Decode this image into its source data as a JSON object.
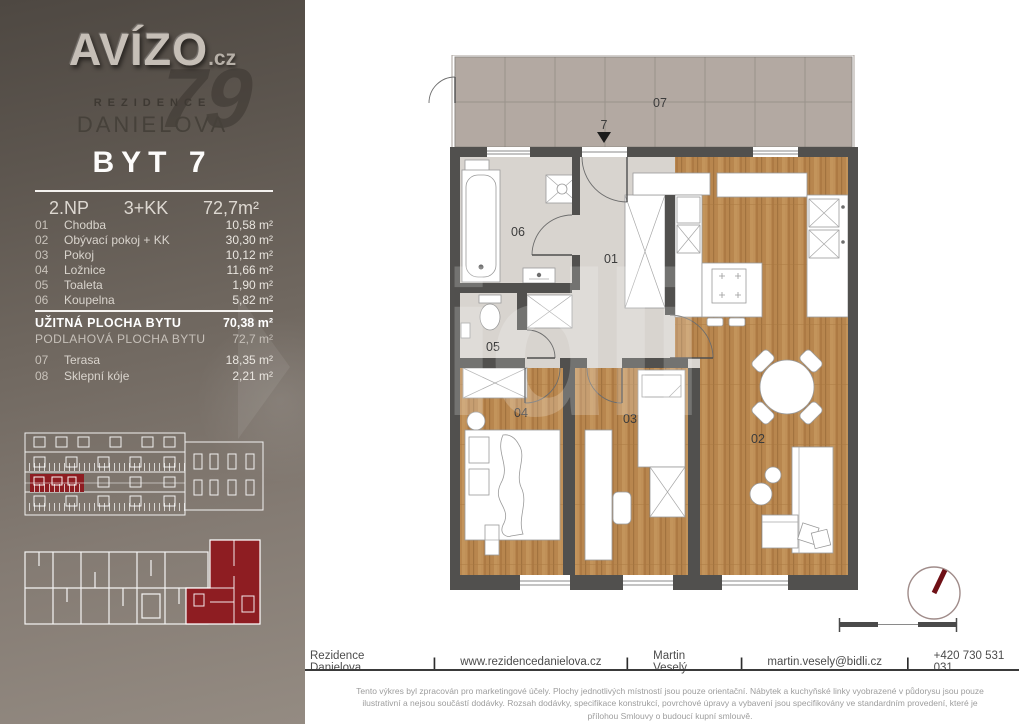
{
  "branding": {
    "logo": "AVÍZO",
    "logo_tld": ".cz",
    "logo_ghost": "79",
    "residence": "REZIDENCE",
    "name": "DANIELOVA"
  },
  "unit": {
    "title": "BYT 7",
    "floor": "2.NP",
    "disposition": "3+KK",
    "area": "72,7m²"
  },
  "rooms": [
    {
      "num": "01",
      "name": "Chodba",
      "area": "10,58 m²"
    },
    {
      "num": "02",
      "name": "Obývací pokoj + KK",
      "area": "30,30 m²"
    },
    {
      "num": "03",
      "name": "Pokoj",
      "area": "10,12 m²"
    },
    {
      "num": "04",
      "name": "Ložnice",
      "area": "11,66 m²"
    },
    {
      "num": "05",
      "name": "Toaleta",
      "area": "1,90 m²"
    },
    {
      "num": "06",
      "name": "Koupelna",
      "area": "5,82 m²"
    }
  ],
  "summary": {
    "usable_label": "UŽITNÁ PLOCHA BYTU",
    "usable_value": "70,38 m²",
    "floor_label": "PODLAHOVÁ PLOCHA BYTU",
    "floor_value": "72,7 m²"
  },
  "extras": [
    {
      "num": "07",
      "name": "Terasa",
      "area": "18,35 m²"
    },
    {
      "num": "08",
      "name": "Sklepní kóje",
      "area": "2,21 m²"
    }
  ],
  "plan_labels": {
    "terrace": "07",
    "entrance_unit": "7",
    "hall": "01",
    "living": "02",
    "room": "03",
    "bedroom": "04",
    "toilet": "05",
    "bathroom": "06"
  },
  "watermark": "bidli",
  "footer": {
    "separator": "|",
    "items": [
      "Rezidence Danielova",
      "www.rezidencedanielova.cz",
      "Martin Veselý",
      "martin.vesely@bidli.cz",
      "+420 730 531 031"
    ]
  },
  "disclaimer": {
    "line1": "Tento výkres byl zpracován pro marketingové účely. Plochy jednotlivých místností jsou pouze orientační. Nábytek a kuchyňské linky vyobrazené v půdorysu jsou pouze",
    "line2": "ilustrativní a nejsou součástí dodávky. Rozsah dodávky, specifikace konstrukcí, povrchové úpravy a vybavení jsou specifikovány ve standardním provedení, které je",
    "line3": "přílohou Smlouvy o budoucí kupní smlouvě."
  },
  "colors": {
    "accent_red": "#8e1d22",
    "wall": "#51504e",
    "wood": "#b8864e",
    "tile_floor": "#d8d4cf",
    "terrace": "#b3a9a2"
  }
}
